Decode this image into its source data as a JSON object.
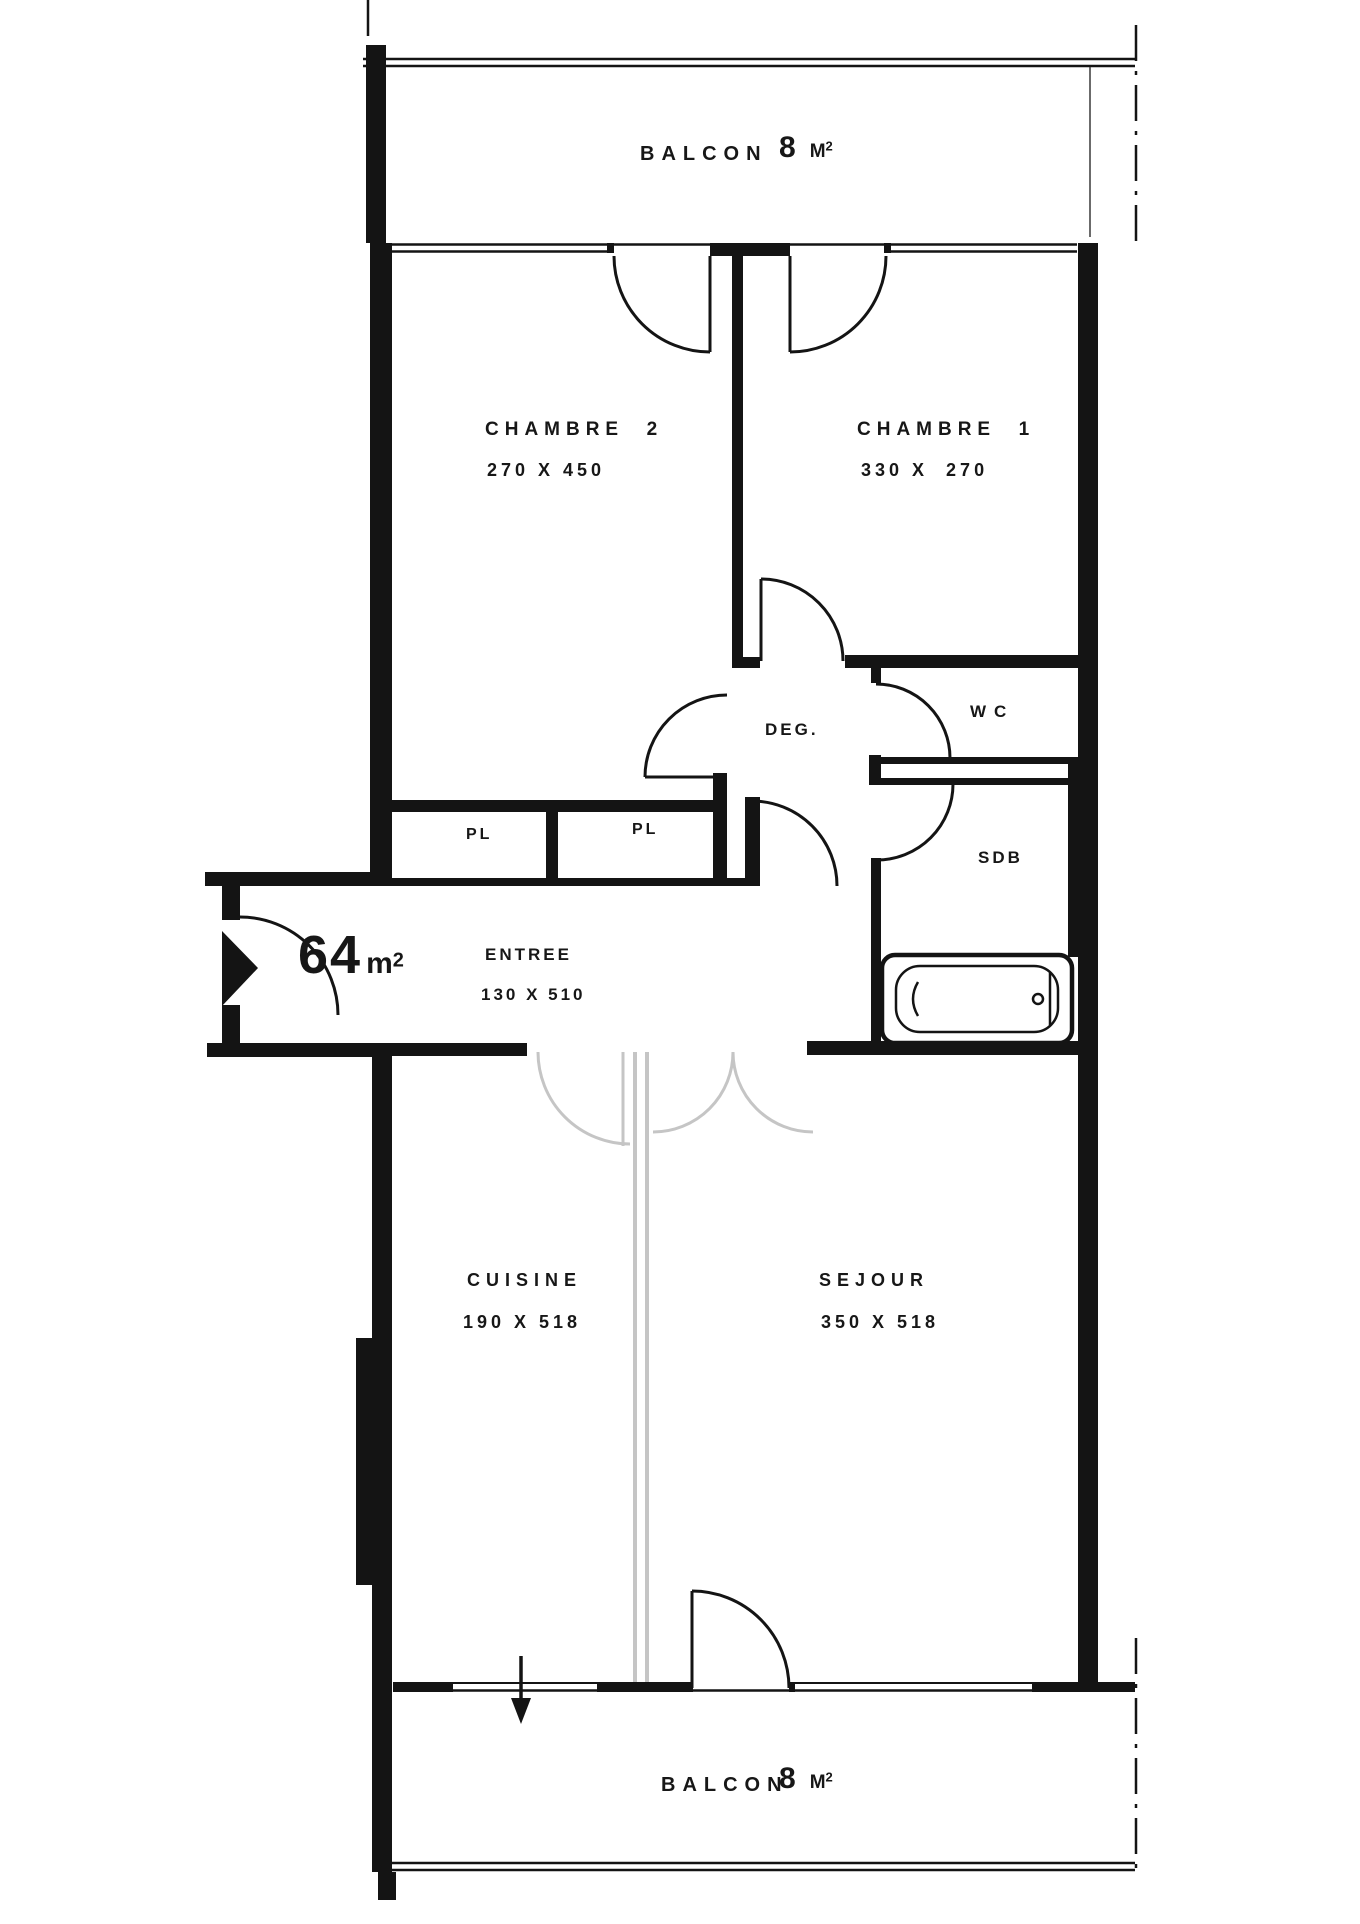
{
  "plan": {
    "colors": {
      "wall": "#141414",
      "light_partition": "#c5c5c5",
      "background": "#ffffff"
    },
    "total_area": {
      "value": "64",
      "unit": "m",
      "sup": "2"
    },
    "balcony_top": {
      "name": "BALCON",
      "area_value": "8",
      "area_unit": "M",
      "area_sup": "2"
    },
    "balcony_bottom": {
      "name": "BALCON",
      "area_value": "8",
      "area_unit": "M",
      "area_sup": "2"
    },
    "rooms": {
      "chambre2": {
        "name": "CHAMBRE  2",
        "dims": "270 X 450"
      },
      "chambre1": {
        "name": "CHAMBRE  1",
        "dims": "330 X  270"
      },
      "degagement": {
        "name": "DEG."
      },
      "wc": {
        "name": "WC"
      },
      "sdb": {
        "name": "SDB"
      },
      "closet_left": {
        "name": "PL"
      },
      "closet_right": {
        "name": "PL"
      },
      "entree": {
        "name": "ENTREE",
        "dims": "130 X 510"
      },
      "cuisine": {
        "name": "CUISINE",
        "dims": "190 X 518"
      },
      "sejour": {
        "name": "SEJOUR",
        "dims": "350 X 518"
      }
    }
  }
}
